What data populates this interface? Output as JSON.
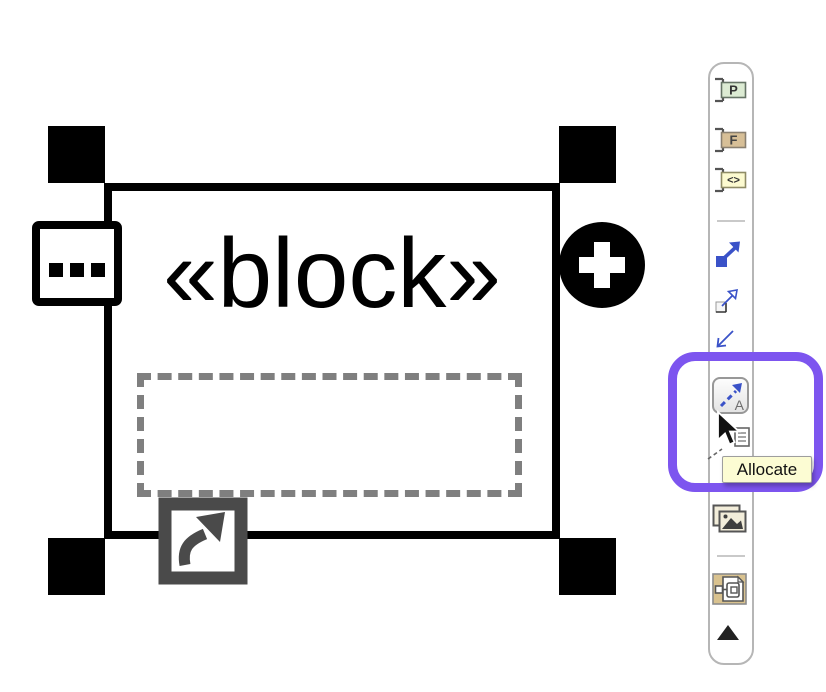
{
  "diagram": {
    "block": {
      "stereotype": "«block»"
    }
  },
  "toolbar": {
    "items": [
      {
        "name": "port-button",
        "label": "P"
      },
      {
        "name": "full-port-button",
        "label": "F"
      },
      {
        "name": "proxy-port-button",
        "label": "<>"
      },
      {
        "name": "filled-arrow-relation-button"
      },
      {
        "name": "open-arrow-relation-button"
      },
      {
        "name": "incoming-arrow-relation-button"
      },
      {
        "name": "allocate-button",
        "label": "A",
        "tooltip": "Allocate"
      },
      {
        "name": "allocated-element-button"
      },
      {
        "name": "insert-image-button"
      },
      {
        "name": "structure-diagram-button"
      },
      {
        "name": "scroll-up-button"
      }
    ]
  },
  "tooltip": {
    "text": "Allocate"
  },
  "icons": {
    "ellipsis-icon": "⋯",
    "plus-icon": "+",
    "navigate-arrow-icon": "↗",
    "port-bracket-icon": "]",
    "filled-arrow-icon": "↗",
    "open-arrow-icon": "↗",
    "incoming-arrow-icon": "↙",
    "allocate-dashed-arrow-icon": "⇗",
    "document-icon": "🗎",
    "image-icon": "🖼",
    "structure-diagram-icon": "▣",
    "scroll-up-icon": "▲",
    "mouse-cursor-icon": "pointer"
  },
  "colors": {
    "highlight-purple": "#7d55ef",
    "arrow-blue": "#3a52c8",
    "tooltip-bg": "#fcfcd3",
    "port-green": "#dcebd3",
    "port-tan": "#d7bf97",
    "port-yellow": "#fcfad0",
    "icon-tan": "#d9c28f",
    "icon-gray": "#4a4a4a"
  }
}
